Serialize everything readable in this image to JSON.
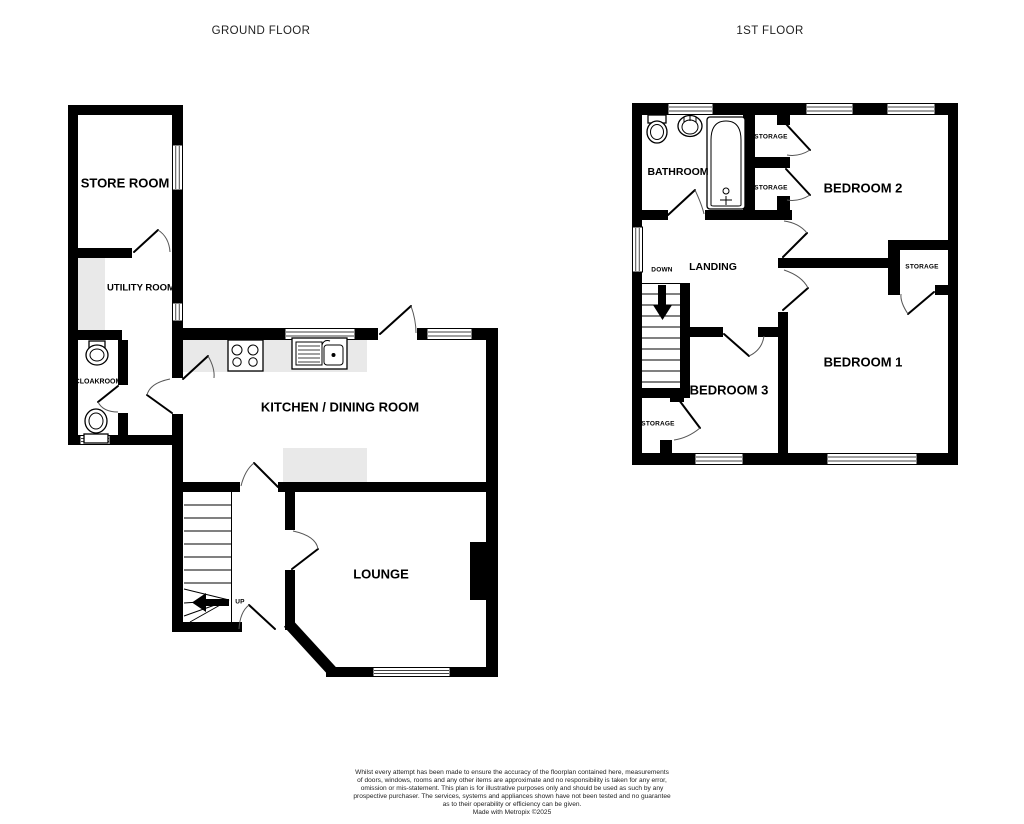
{
  "titles": {
    "ground_floor": "GROUND FLOOR",
    "first_floor": "1ST FLOOR"
  },
  "ground_floor": {
    "rooms": {
      "store_room": "STORE ROOM",
      "utility_room": "UTILITY ROOM",
      "cloakroom": "CLOAKROOM",
      "kitchen_dining": "KITCHEN / DINING ROOM",
      "lounge": "LOUNGE"
    },
    "stairs_label": "UP"
  },
  "first_floor": {
    "rooms": {
      "bathroom": "BATHROOM",
      "landing": "LANDING",
      "bedroom_1": "BEDROOM 1",
      "bedroom_2": "BEDROOM 2",
      "bedroom_3": "BEDROOM 3",
      "storage_top_1": "STORAGE",
      "storage_top_2": "STORAGE",
      "storage_bedroom_1": "STORAGE",
      "storage_bedroom_3": "STORAGE"
    },
    "stairs_label": "DOWN"
  },
  "footer": {
    "disclaimer_lines": [
      "Whilst every attempt has been made to ensure the accuracy of the floorplan contained here, measurements",
      "of doors, windows, rooms and any other items are approximate and no responsibility is taken for any error,",
      "omission or mis-statement. This plan is for illustrative purposes only and should be used as such by any",
      "prospective purchaser. The services, systems and appliances shown have not been tested and no guarantee",
      "as to their operability or efficiency can be given."
    ],
    "credit": "Made with Metropix ©2025"
  },
  "colors": {
    "wall": "#000000",
    "counter_fill": "#e9e9e9",
    "background": "#ffffff",
    "text": "#000000",
    "title_text": "#1f1f1f"
  }
}
